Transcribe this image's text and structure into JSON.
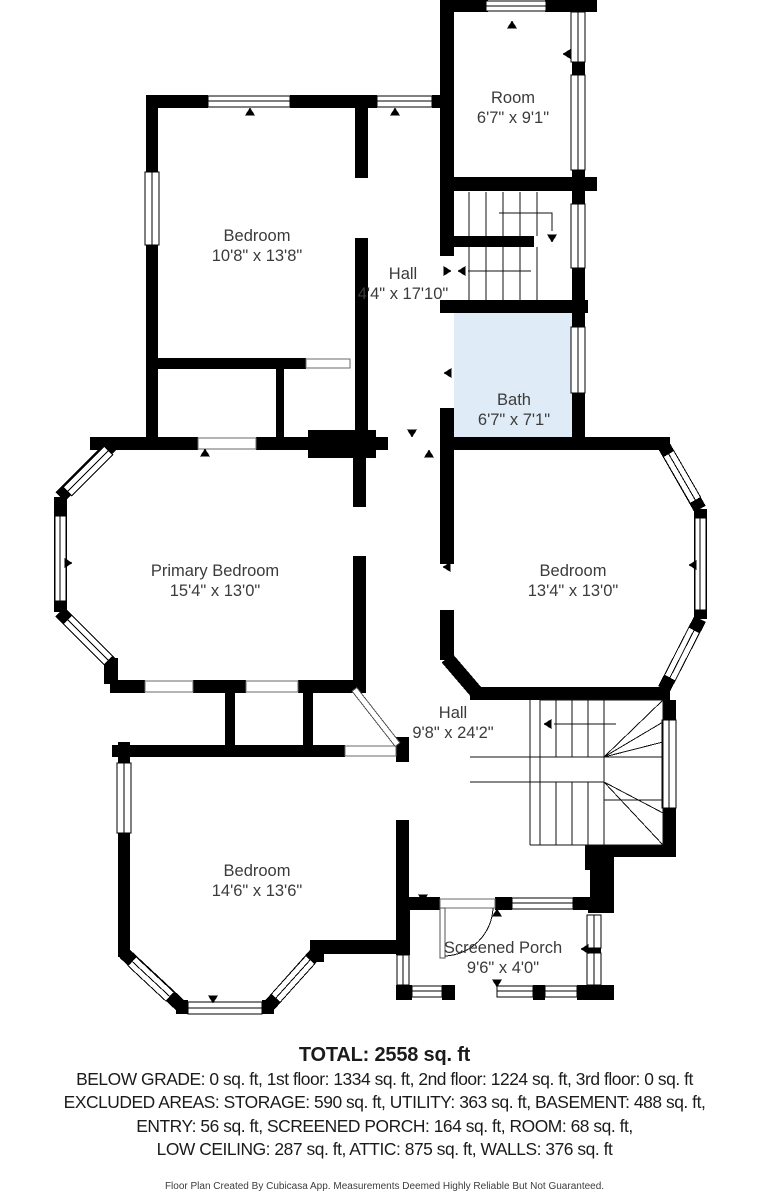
{
  "plan": {
    "floor_fill": "#ffffff",
    "colors": {
      "wall": "#000000",
      "bath_fill": "#dfecf8",
      "label_text": "#3b3b3b"
    },
    "rooms": [
      {
        "id": "room",
        "name": "Room",
        "dims": "6'7\" x 9'1\""
      },
      {
        "id": "bedroom-top",
        "name": "Bedroom",
        "dims": "10'8\" x 13'8\""
      },
      {
        "id": "hall-upper",
        "name": "Hall",
        "dims": "4'4\" x 17'10\""
      },
      {
        "id": "bath",
        "name": "Bath",
        "dims": "6'7\" x 7'1\""
      },
      {
        "id": "primary-bedroom",
        "name": "Primary Bedroom",
        "dims": "15'4\" x 13'0\""
      },
      {
        "id": "bedroom-right",
        "name": "Bedroom",
        "dims": "13'4\" x 13'0\""
      },
      {
        "id": "hall-lower",
        "name": "Hall",
        "dims": "9'8\" x 24'2\""
      },
      {
        "id": "bedroom-bottom",
        "name": "Bedroom",
        "dims": "14'6\" x 13'6\""
      },
      {
        "id": "screened-porch",
        "name": "Screened Porch",
        "dims": "9'6\" x 4'0\""
      }
    ]
  },
  "summary": {
    "total": "TOTAL: 2558 sq. ft",
    "line1": "BELOW GRADE: 0 sq. ft, 1st floor: 1334 sq. ft, 2nd floor: 1224 sq. ft, 3rd floor: 0 sq. ft",
    "line2": "EXCLUDED AREAS: STORAGE: 590 sq. ft, UTILITY: 363 sq. ft, BASEMENT: 488 sq. ft,",
    "line3": "ENTRY: 56 sq. ft, SCREENED PORCH: 164 sq. ft, ROOM: 68 sq. ft,",
    "line4": "LOW CEILING: 287 sq. ft, ATTIC: 875 sq. ft, WALLS: 376 sq. ft",
    "disclaimer": "Floor Plan Created By Cubicasa App. Measurements Deemed Highly Reliable But Not Guaranteed."
  }
}
